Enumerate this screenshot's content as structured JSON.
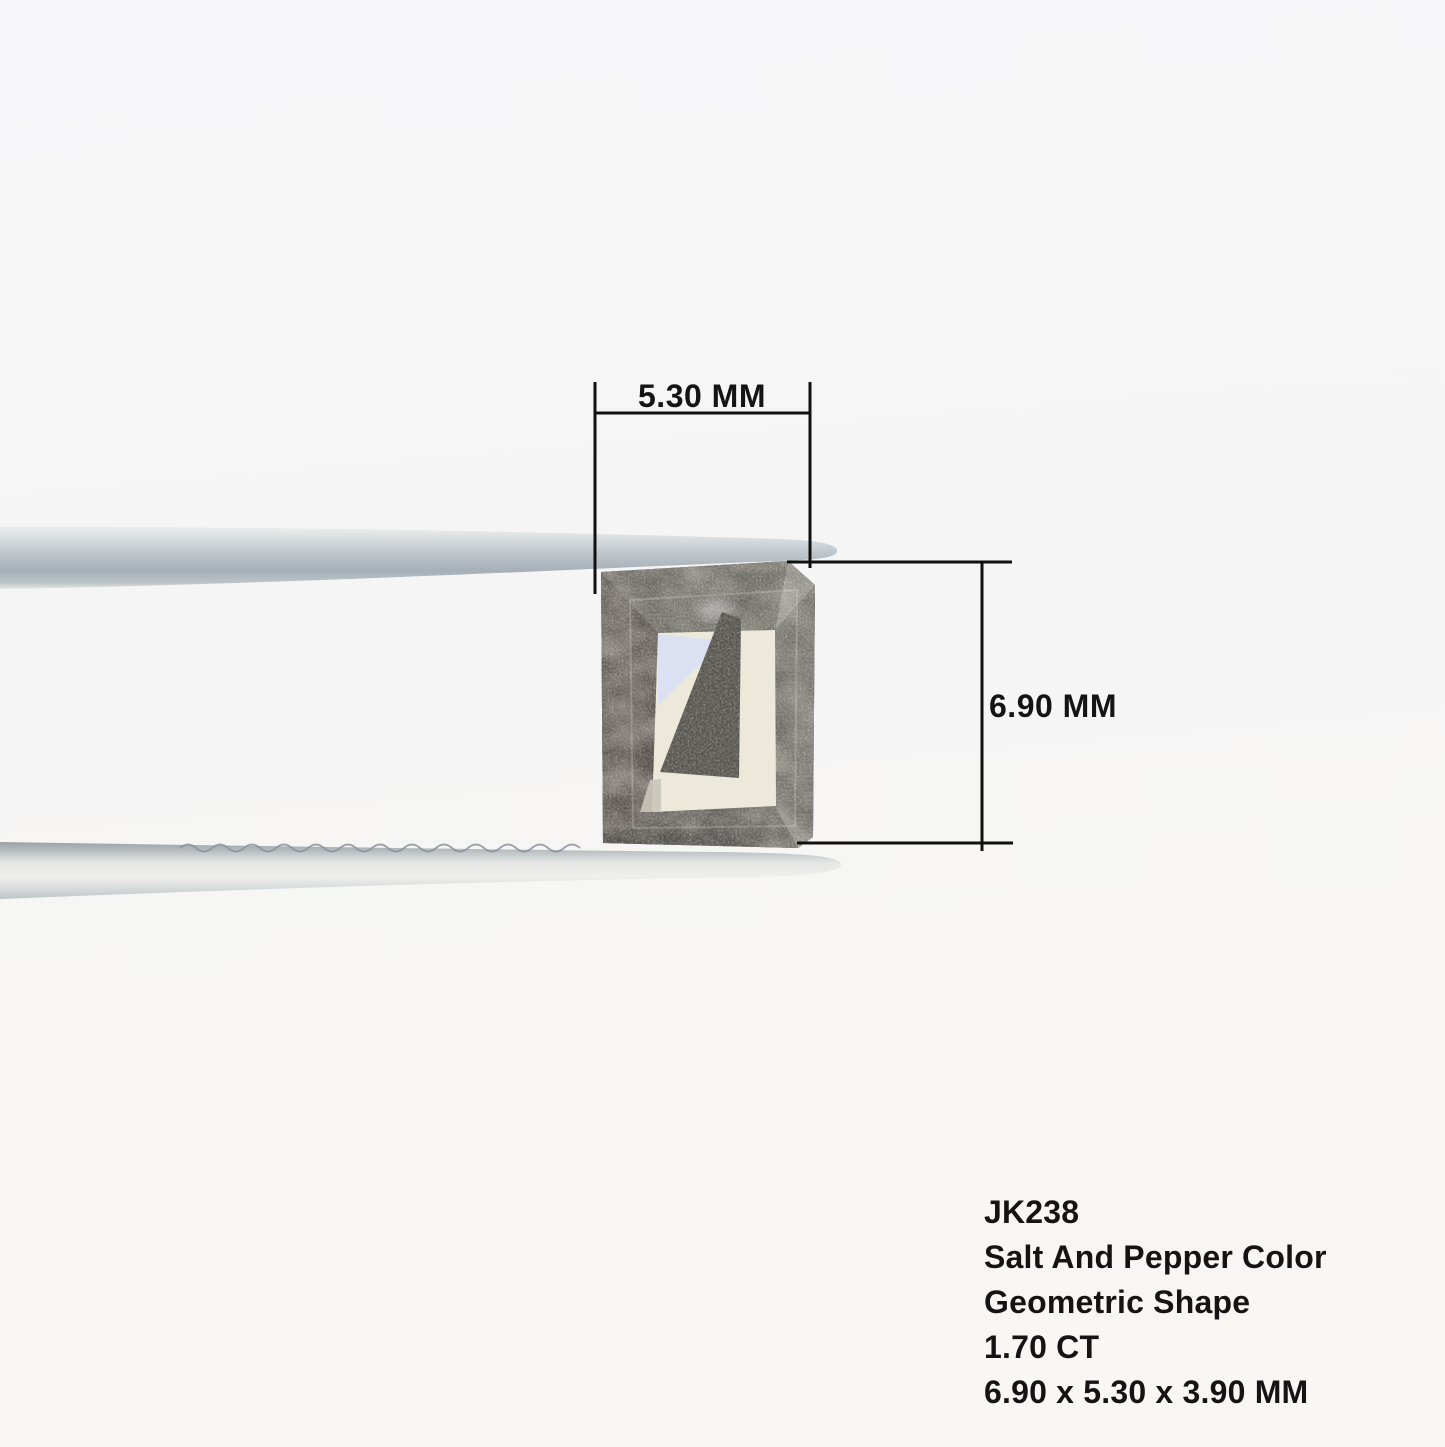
{
  "annotations": {
    "width_label": "5.30 MM",
    "height_label": "6.90 MM"
  },
  "info": {
    "sku": "JK238",
    "color": "Salt And Pepper Color",
    "shape": "Geometric Shape",
    "carat": "1.70 CT",
    "dimensions": "6.90 x 5.30 x 3.90 MM"
  },
  "colors": {
    "background": "#f7f6f5",
    "annotation_line": "#111111",
    "annotation_text": "#141414",
    "diamond_base": "#5f5d58",
    "diamond_top_band": "#6a6862",
    "diamond_left_band": "#55504a",
    "diamond_right_band": "#6f6d67",
    "diamond_bottom_band": "#514f4a",
    "diamond_bevel_light": "#8d8c85",
    "diamond_table": "#ece9db",
    "diamond_table_blue": "#dbe0f2",
    "diamond_wedge": "#56544e",
    "tweezer_metal": "#bcc4c9"
  }
}
